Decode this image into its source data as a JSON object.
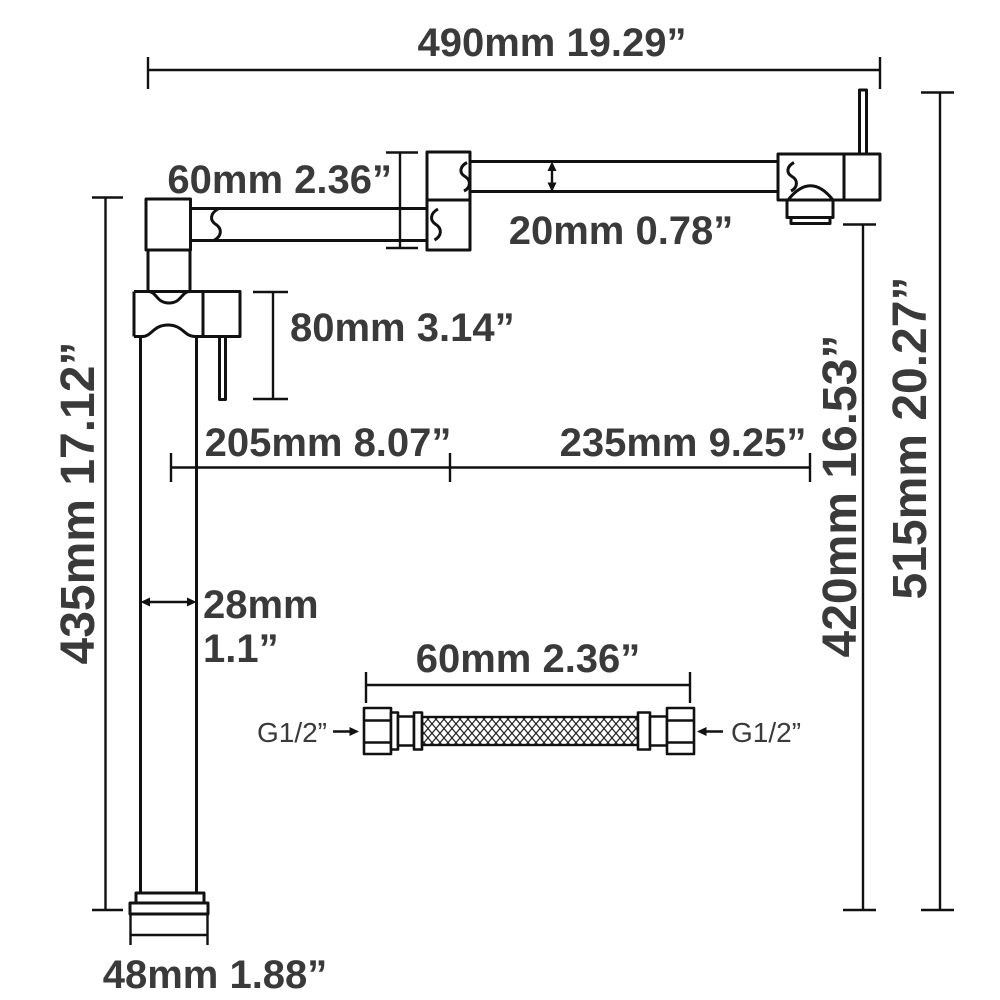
{
  "page": {
    "background": "#ffffff",
    "line_color": "#111111",
    "text_color": "#3a3a3a",
    "description": "Pot filler faucet technical dimension diagram with flexible hose detail"
  },
  "diagram": {
    "labels": {
      "width_overall": "490mm 19.29”",
      "joint_height": "60mm 2.36”",
      "tube_diameter": "20mm 0.78”",
      "handle_height": "80mm 3.14”",
      "column_height": "435mm 17.12”",
      "reach_left": "205mm 8.07”",
      "reach_right": "235mm 9.25”",
      "spout_height": "420mm 16.53”",
      "total_height": "515mm 20.27”",
      "pipe_width_mm": "28mm",
      "pipe_width_in": "1.1”",
      "base_width": "48mm 1.88”",
      "hose_length": "60mm 2.36”",
      "hose_thread_left": "G1/2”",
      "hose_thread_right": "G1/2”"
    }
  }
}
